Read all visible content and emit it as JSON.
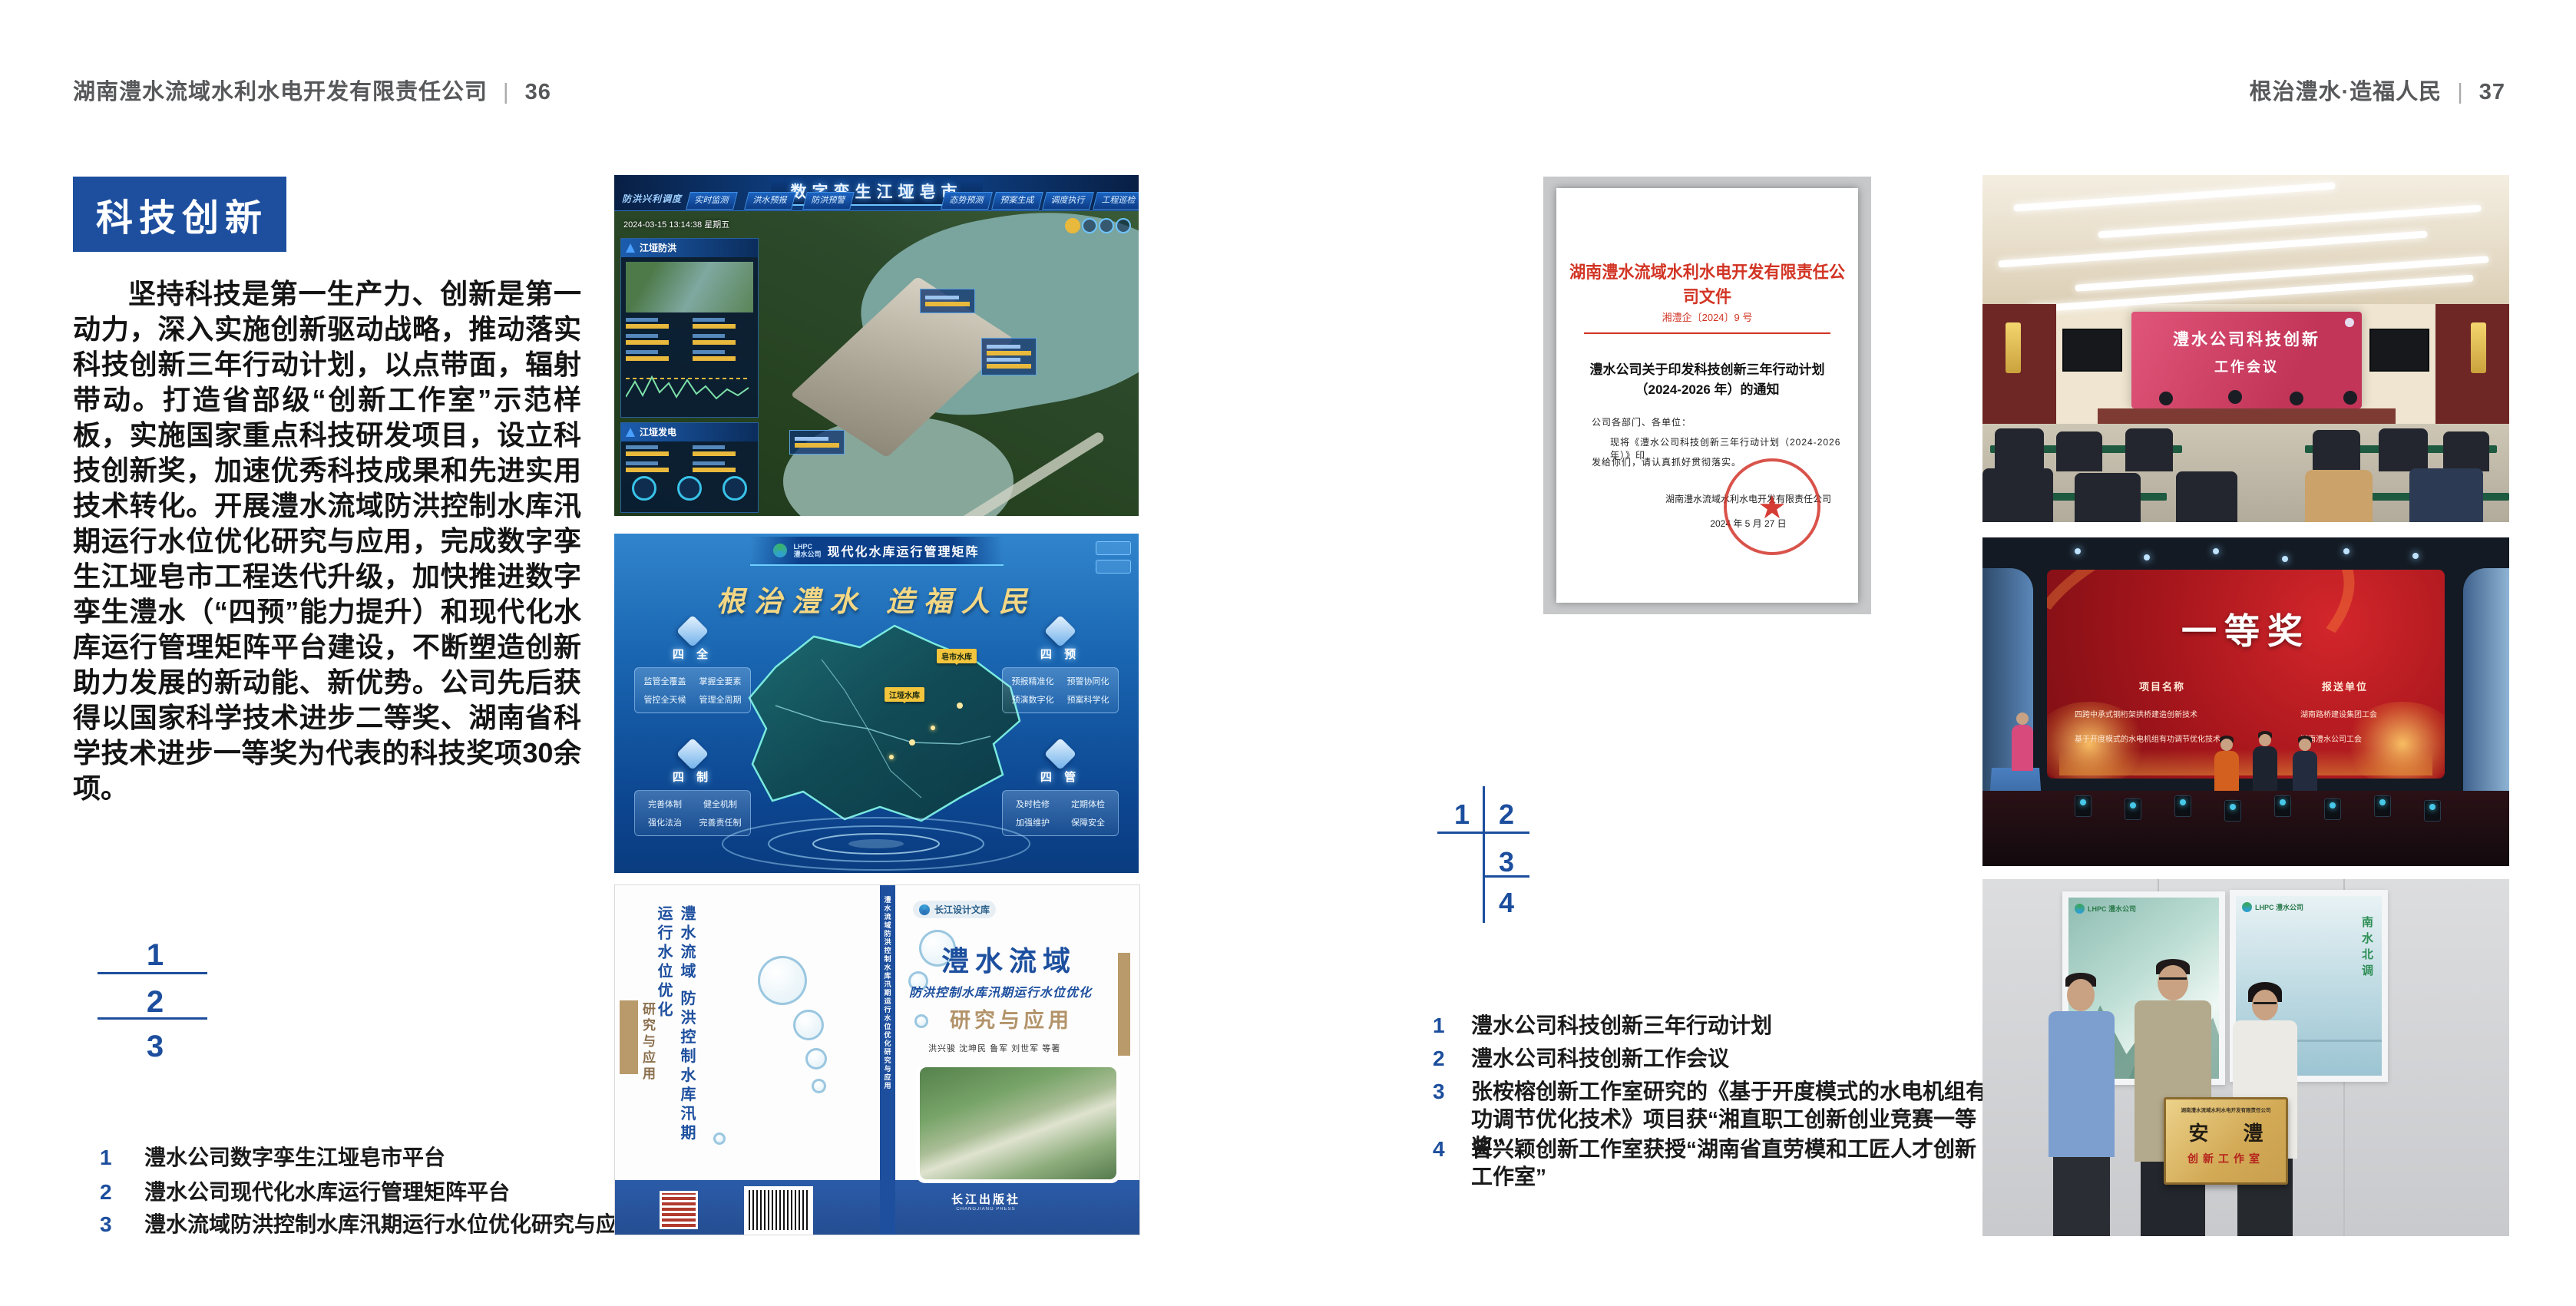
{
  "colors": {
    "accent_blue": "#1d4f9e",
    "doc_red": "#d23424",
    "gold": "#e8c169"
  },
  "header_left": {
    "company": "湖南澧水流域水利水电开发有限责任公司",
    "sep": "|",
    "page": "36"
  },
  "header_right": {
    "slogan": "根治澧水·造福人民",
    "sep": "|",
    "page": "37"
  },
  "section": {
    "title": "科技创新"
  },
  "body_paragraph": "坚持科技是第一生产力、创新是第一动力，深入实施创新驱动战略，推动落实科技创新三年行动计划，以点带面，辐射带动。打造省部级“创新工作室”示范样板，实施国家重点科技研发项目，设立科技创新奖，加速优秀科技成果和先进实用技术转化。开展澧水流域防洪控制水库汛期运行水位优化研究与应用，完成数字孪生江垭皂市工程迭代升级，加快推进数字孪生澧水（“四预”能力提升）和现代化水库运行管理矩阵平台建设，不断塑造创新助力发展的新动能、新优势。公司先后获得以国家科学技术进步二等奖、湖南省科学技术进步一等奖为代表的科技奖项30余项。",
  "left_figures": {
    "n1": "1",
    "n2": "2",
    "n3": "3",
    "captions": [
      {
        "n": "1",
        "t": "澧水公司数字孪生江垭皂市平台"
      },
      {
        "n": "2",
        "t": "澧水公司现代化水库运行管理矩阵平台"
      },
      {
        "n": "3",
        "t": "澧水流域防洪控制水库汛期运行水位优化研究与应用"
      }
    ]
  },
  "right_figures": {
    "n1": "1",
    "n2": "2",
    "n3": "3",
    "n4": "4",
    "captions": [
      {
        "n": "1",
        "t": "澧水公司科技创新三年行动计划"
      },
      {
        "n": "2",
        "t": "澧水公司科技创新工作会议"
      },
      {
        "n": "3",
        "t": "张桉榕创新工作室研究的《基于开度模式的水电机组有功调节优化技术》项目获“湘直职工创新创业竞赛一等奖”"
      },
      {
        "n": "4",
        "t": "曾兴颖创新工作室获授“湖南省直劳模和工匠人才创新工作室”"
      }
    ]
  },
  "dashboard": {
    "title": "数字孪生江垭皂市",
    "menu_label": "防洪兴利调度",
    "tabs_left": [
      "实时监测",
      "洪水预报",
      "防洪预警"
    ],
    "tabs_right": [
      "态势预测",
      "预案生成",
      "调度执行",
      "工程巡检"
    ],
    "datetime": "2024-03-15 13:14:38 星期五",
    "panel1": "江垭防洪",
    "panel2": "江垭发电"
  },
  "matrix": {
    "logo_line1": "LHPC",
    "logo_line2": "澧水公司",
    "title": "现代化水库运行管理矩阵",
    "slogan": "根治澧水  造福人民",
    "marker1": "江垭水库",
    "marker2": "皂市水库",
    "groups": [
      {
        "name": "四 全",
        "items": [
          "监管全覆盖",
          "掌握全要素",
          "管控全天候",
          "管理全周期"
        ]
      },
      {
        "name": "四 预",
        "items": [
          "预报精准化",
          "预警协同化",
          "预演数字化",
          "预案科学化"
        ]
      },
      {
        "name": "四 制",
        "items": [
          "完善体制",
          "健全机制",
          "强化法治",
          "完善责任制"
        ]
      },
      {
        "name": "四 管",
        "items": [
          "及时检修",
          "定期体检",
          "加强维护",
          "保障安全"
        ]
      }
    ]
  },
  "book": {
    "series": "长江设计文库",
    "title": "澧水流域",
    "subtitle": "防洪控制水库汛期运行水位优化",
    "subtitle2": "研究与应用",
    "authors": "洪兴骏  沈坤民  鲁军  刘世军  等著",
    "back_vertical": "澧水流域 防洪控制水库汛期运行水位优化",
    "back_study": "研究与应用",
    "spine": "澧水流域防洪控制水库汛期运行水位优化研究与应用",
    "publisher_cn": "长江出版社",
    "publisher_en": "CHANGJIANG PRESS"
  },
  "document": {
    "header": "湖南澧水流域水利水电开发有限责任公司文件",
    "doc_no": "湘澧企〔2024〕9 号",
    "title1": "澧水公司关于印发科技创新三年行动计划",
    "title2": "（2024-2026 年）的通知",
    "salutation": "公司各部门、各单位：",
    "body1": "现将《澧水公司科技创新三年行动计划（2024-2026 年）》印",
    "body2": "发给你们，请认真抓好贯彻落实。",
    "seal_star": "★",
    "signer": "湖南澧水流域水利水电开发有限责任公司",
    "date": "2024 年 5 月 27 日"
  },
  "meeting": {
    "screen_line1": "澧水公司科技创新",
    "screen_line2": "工作会议"
  },
  "award": {
    "prize": "一等奖",
    "col1": "项目名称",
    "col2": "报送单位",
    "row1_project": "四跨中承式钢桁架拱桥建造创新技术",
    "row1_unit": "湖南路桥建设集团工会",
    "row2_project": "基于开度模式的水电机组有功调节优化技术",
    "row2_unit": "湖南澧水公司工会"
  },
  "plaque": {
    "logo": "LHPC 澧水公司",
    "poster_right_text": "南水北调",
    "org_line": "湖南澧水流域水利水电开发有限责任公司",
    "big": "安 澧",
    "sub": "创新工作室"
  }
}
